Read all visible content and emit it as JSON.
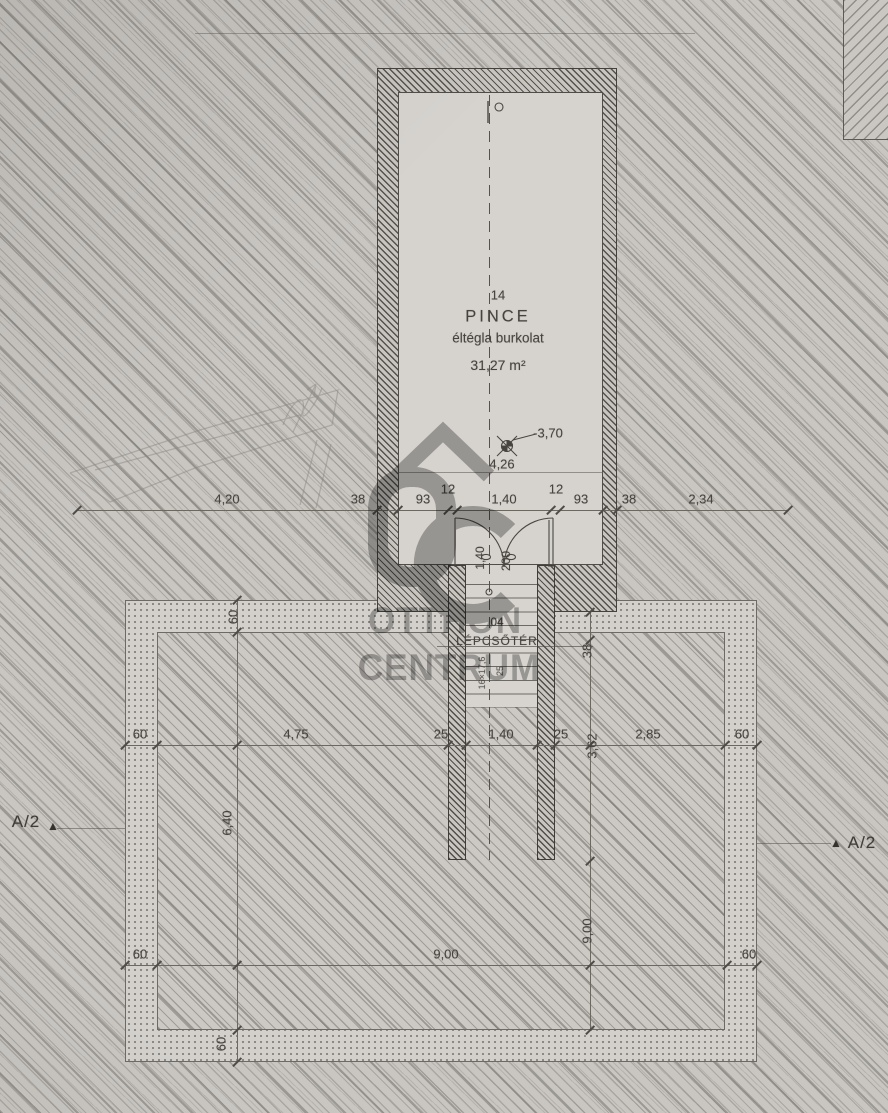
{
  "plan": {
    "room": {
      "number": "14",
      "name": "PINCE",
      "finish": "éltégla burkolat",
      "area": "31,27 m²"
    },
    "stairwell": {
      "number": "04",
      "name": "LÉPCSŐTÉR",
      "stair_note_a": "16×17,6",
      "stair_note_b": "25"
    },
    "levels": {
      "floor": "-3,70",
      "clear_height": "4,26"
    },
    "door": {
      "width": "1,40",
      "height": "200"
    }
  },
  "dims": {
    "top_row": [
      "4,20",
      "38",
      "93",
      "12",
      "1,40",
      "12",
      "93",
      "38",
      "2,34"
    ],
    "mid_row": [
      "60",
      "4,75",
      "25",
      "1,40",
      "25",
      "2,85",
      "60"
    ],
    "bottom_row": [
      "60",
      "9,00",
      "60"
    ],
    "vertical": [
      "60",
      "6,40",
      "60",
      "38",
      "3,62",
      "9,00"
    ]
  },
  "section_marker": {
    "label": "A/2",
    "arrow": "▲"
  },
  "watermark": {
    "monogram": "OC",
    "line1": "OTTHON",
    "line2": "CENTRUM"
  },
  "colors": {
    "paper": "#c9c6c2",
    "ink": "#46433e",
    "watermark": "#767676"
  }
}
